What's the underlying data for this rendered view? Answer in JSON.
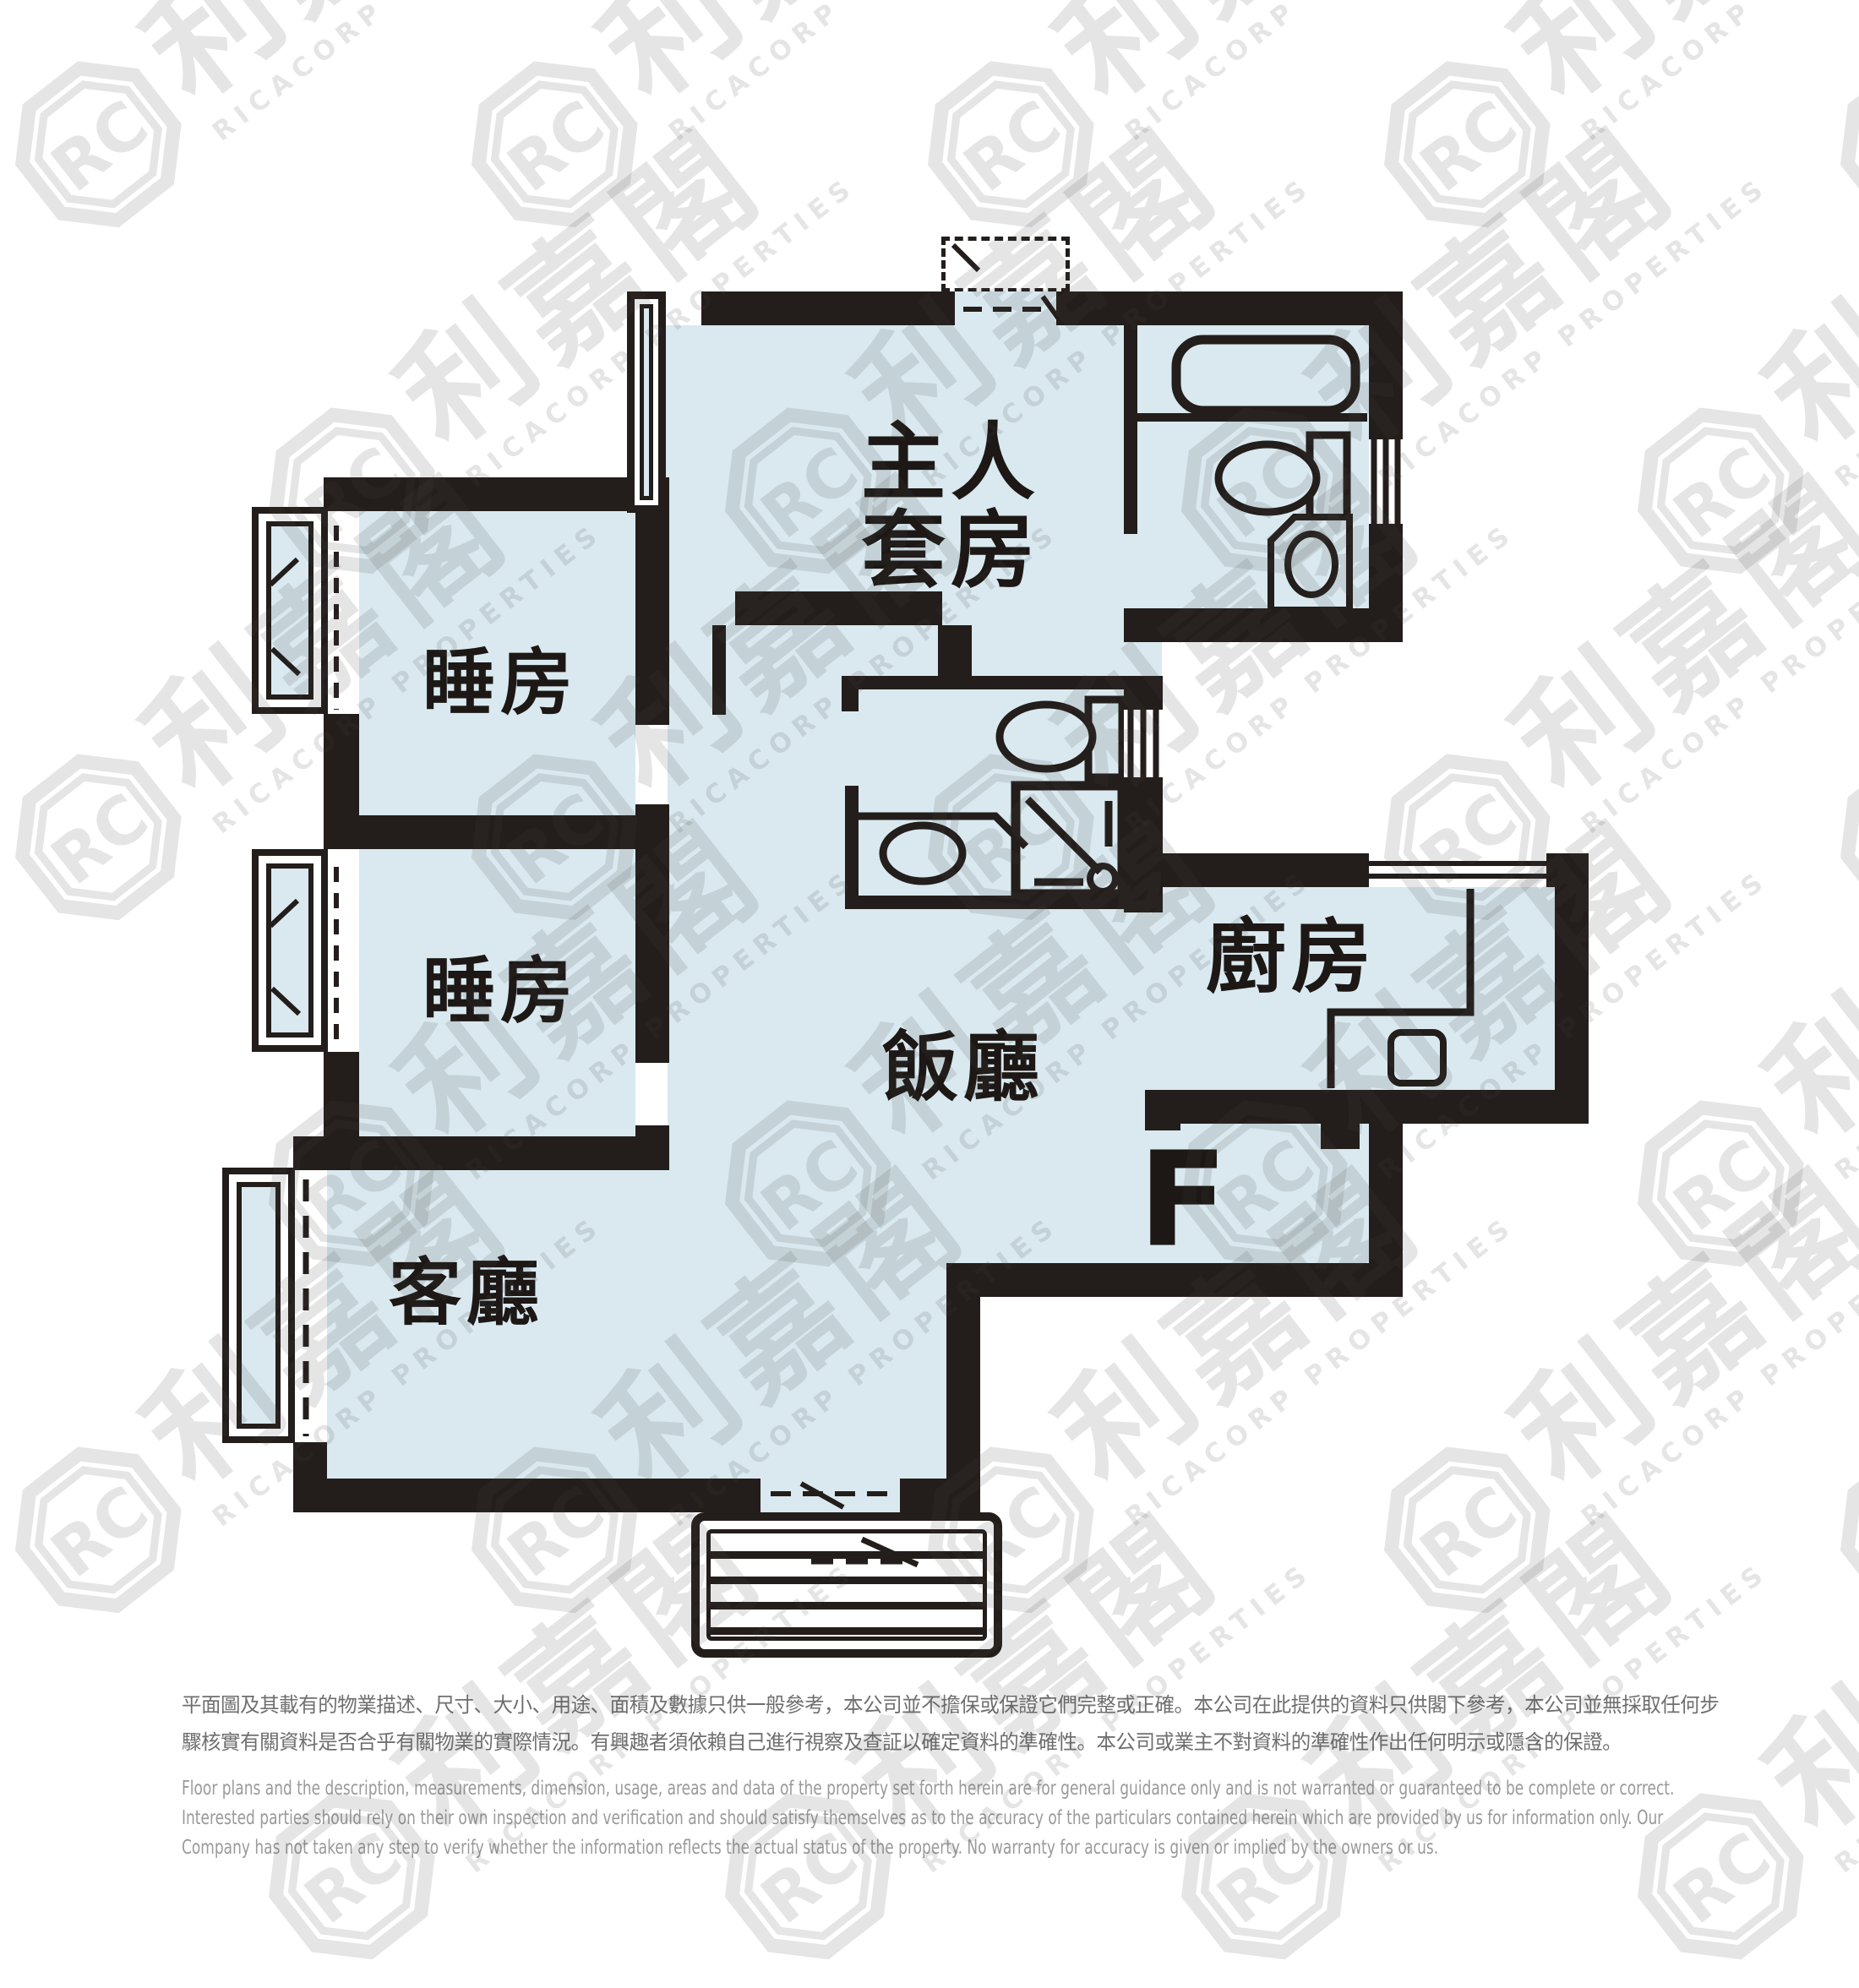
{
  "floor_plan": {
    "unit": {
      "label": "F"
    },
    "rooms": {
      "master_suite": {
        "line1": "主人",
        "line2": "套房"
      },
      "bedroom_1": {
        "label": "睡房"
      },
      "bedroom_2": {
        "label": "睡房"
      },
      "living_room": {
        "label": "客廳"
      },
      "dining_room": {
        "label": "飯廳"
      },
      "kitchen": {
        "label": "廚房"
      }
    },
    "colors": {
      "room_fill": "#d9e9ef",
      "wall": "#231e1b",
      "watermark": "#e9e9e9",
      "disclaimer_zh": "#6f6f6f",
      "disclaimer_en": "#9a9a9a"
    }
  },
  "watermark": {
    "logo_monogram": "RC",
    "logo_text": "利嘉閣",
    "subtext": "RICACORP PROPERTIES"
  },
  "disclaimer": {
    "zh_line1": "平面圖及其載有的物業描述、尺寸、大小、用途、面積及數據只供一般參考，本公司並不擔保或保證它們完整或正確。本公司在此提供的資料只供閣下參考，本公司並無採取任何步",
    "zh_line2": "驟核實有關資料是否合乎有關物業的實際情況。有興趣者須依賴自己進行視察及查証以確定資料的準確性。本公司或業主不對資料的準確性作出任何明示或隱含的保證。",
    "en_line1": "Floor plans and the description, measurements, dimension, usage, areas and data of the property set forth herein are for general guidance only and is not warranted or guaranteed to be complete or correct.",
    "en_line2": "Interested parties should rely on their own inspection and verification and should satisfy themselves as to the accuracy of the particulars contained herein which are provided by us for information only.  Our",
    "en_line3": "Company has not taken any step to verify whether the information reflects the actual status of the property.  No warranty for accuracy is given or implied by the owners or us."
  }
}
